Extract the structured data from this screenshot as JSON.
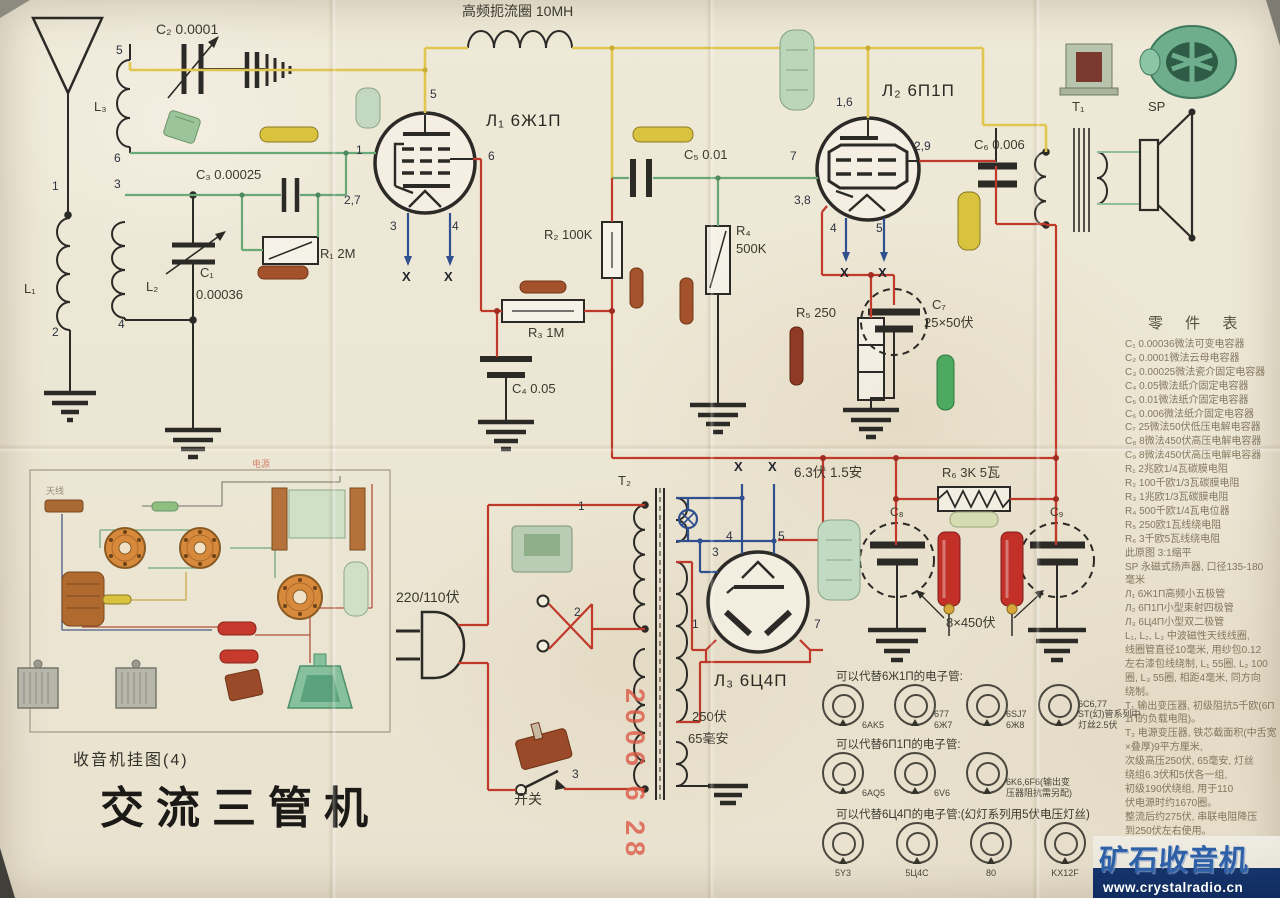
{
  "labels": {
    "choke": "高频扼流圈 10MH",
    "c2": "C₂ 0.0001",
    "c3": "C₃ 0.00025",
    "c1a": "C₁",
    "c1b": "0.00036",
    "r1": "R₁ 2M",
    "l1": "L₁",
    "l2": "L₂",
    "l3": "L₃",
    "tube1": "Л₁ 6Ж1П",
    "r2": "R₂ 100K",
    "r3": "R₃ 1M",
    "c4": "C₄ 0.05",
    "c5": "C₅ 0.01",
    "r4a": "R₄",
    "r4b": "500K",
    "tube2": "Л₂ 6П1П",
    "c6": "C₆ 0.006",
    "t1": "T₁",
    "sp": "SP",
    "r5": "R₅ 250",
    "c7a": "C₇",
    "c7b": "25×50伏",
    "heater": "6.3伏 1.5安",
    "r6": "R₆ 3K 5瓦",
    "c8": "C₈",
    "c9": "C₉",
    "cap450": "8×450伏",
    "tube3": "Л₃ 6Ц4П",
    "t2": "T₂",
    "mains": "220/110伏",
    "sw": "开关",
    "hv1": "250伏",
    "hv2": "65毫安",
    "x": "X"
  },
  "pins": {
    "n1": "1",
    "n2": "2",
    "n3": "3",
    "n4": "4",
    "n5": "5",
    "n6": "6",
    "n7": "7"
  },
  "volts": {
    "v27": "2,7",
    "v16": "1,6",
    "v29": "2,9",
    "v38": "3,8"
  },
  "title_block": {
    "series": "收音机挂图(4)",
    "title": "交流三管机"
  },
  "stamps": {
    "date_left": "2006  6  28",
    "date_mid": "2006  6  28"
  },
  "parts_list": {
    "heading": "零 件 表",
    "lines": [
      "C₁ 0.00036微法可变电容器",
      "C₂ 0.0001微法云母电容器",
      "C₃ 0.00025微法瓷介固定电容器",
      "C₄ 0.05微法纸介固定电容器",
      "C₅ 0.01微法纸介固定电容器",
      "C₆ 0.006微法纸介固定电容器",
      "C₇ 25微法50伏低压电解电容器",
      "C₈ 8微法450伏高压电解电容器",
      "C₉ 8微法450伏高压电解电容器",
      "R₁ 2兆欧1/4瓦碳膜电阻",
      "R₂ 100千欧1/3瓦碳膜电阻",
      "R₃ 1兆欧1/3瓦碳膜电阻",
      "R₄ 500千欧1/4瓦电位器",
      "R₅ 250欧1瓦线绕电阻",
      "R₆ 3千欧5瓦线绕电阻",
      "此原图  3:1缩平",
      "SP 永磁式扬声器, 口径135-180",
      "毫米",
      "Л₁ 6Ж1П高频小五极管",
      "Л₂ 6П1П小型束射四极管",
      "Л₃ 6Ц4П小型双二极管",
      "L₁, L₂, L₃ 中波磁性天线线圈,",
      "线圈管直径10毫米, 用纱包0.12",
      "左右漆包线绕制, L₁ 55圈, L₂ 100",
      "圈, L₃ 55圈, 相距4毫米, 同方向",
      "绕制。",
      "T₁ 输出变压器, 初级阻抗5千欧(6П",
      "1П的负载电阻)。",
      "T₂ 电源变压器, 铁芯截面积(中舌宽度",
      "×叠厚)9平方厘米,",
      "次级高压250伏, 65毫安, 灯丝",
      "绕组6.3伏和5伏各一组,",
      "初级190伏绕组, 用于110",
      "伏电源时约1670圈。",
      "整流后约275伏, 串联电阻降压",
      "到250伏左右使用。"
    ]
  },
  "substitutions": {
    "rows": [
      {
        "heading": "可以代替6Ж1П的电子管:",
        "tubes": [
          "6AK5",
          "677\n6Ж7",
          "6SJ7\n6Ж8",
          "6C6,77\nST(幻)管系列中灯丝2.5伏"
        ]
      },
      {
        "heading": "可以代替6П1П的电子管:",
        "tubes": [
          "6AQ5",
          "6V6",
          "6K6,6F6(输出变\n压器阻抗需另配)"
        ]
      },
      {
        "heading": "可以代替6Ц4П的电子管:(幻灯系列用5伏电压灯丝)",
        "tubes": [
          "5Y3",
          "5Ц4C",
          "80",
          "KX12F"
        ]
      }
    ]
  },
  "watermark": {
    "logo": "矿石收音机",
    "url": "www.crystalradio.cn"
  },
  "pictorial": {
    "ant": "天线",
    "pwr": "电源"
  }
}
